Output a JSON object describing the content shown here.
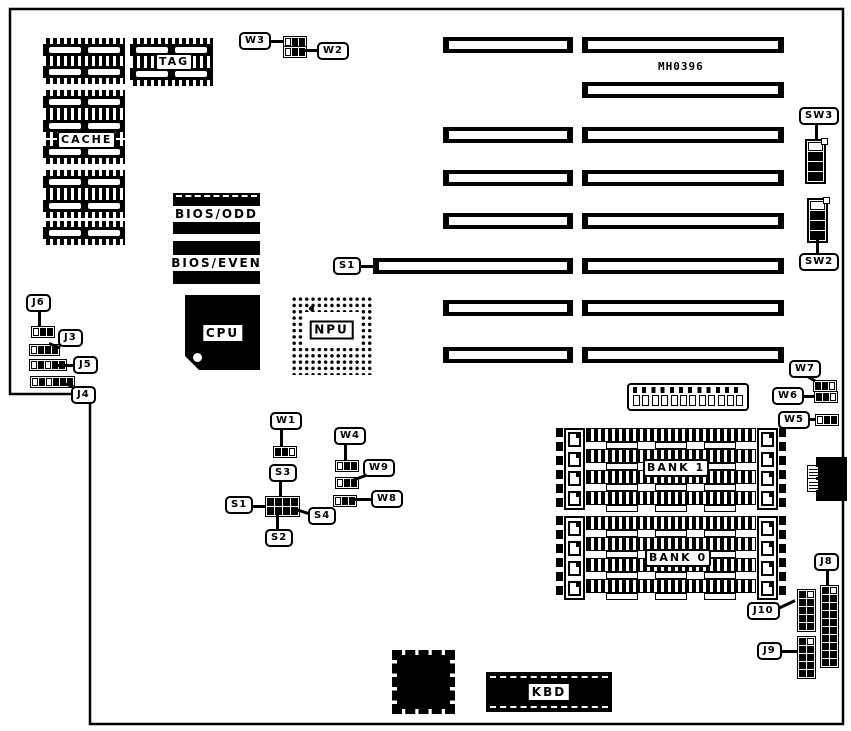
{
  "board": {
    "part_number": "MH0396"
  },
  "components": {
    "cache": {
      "label": "CACHE"
    },
    "tag": {
      "label": "TAG"
    },
    "bios_odd": {
      "label": "BIOS/ODD"
    },
    "bios_even": {
      "label": "BIOS/EVEN"
    },
    "cpu": {
      "label": "CPU"
    },
    "npu": {
      "label": "NPU"
    },
    "kbd": {
      "label": "KBD"
    },
    "bank1": {
      "label": "BANK 1"
    },
    "bank0": {
      "label": "BANK 0"
    }
  },
  "callouts": {
    "w1": {
      "label": "W1",
      "cells": "ffo"
    },
    "w2": {
      "label": "W2",
      "cells": "off"
    },
    "w3": {
      "label": "W3",
      "cells": "off"
    },
    "w4": {
      "label": "W4",
      "cells": "off"
    },
    "w5": {
      "label": "W5",
      "cells": "off"
    },
    "w6": {
      "label": "W6",
      "cells": "ffo"
    },
    "w7": {
      "label": "W7",
      "cells": "ffo"
    },
    "w8": {
      "label": "W8",
      "cells": "off"
    },
    "w9": {
      "label": "W9",
      "cells": "off"
    },
    "j3": {
      "label": "J3",
      "cells": "offf"
    },
    "j4": {
      "label": "J4",
      "cells": "ofofff"
    },
    "j5": {
      "label": "J5",
      "cells": "ofoff"
    },
    "j6": {
      "label": "J6",
      "cells": "off"
    },
    "j8": {
      "label": "J8",
      "cells": "foffffffffffffffffff"
    },
    "j9": {
      "label": "J9",
      "cells": "foffffffff"
    },
    "j10": {
      "label": "J10",
      "cells": "foffffffff"
    },
    "sw2": {
      "label": "SW2",
      "cells": "offf"
    },
    "sw3": {
      "label": "SW3",
      "cells": "offf"
    },
    "s1": {
      "label": "S1"
    },
    "s2": {
      "label": "S2"
    },
    "s3": {
      "label": "S3"
    },
    "s4": {
      "label": "S4"
    },
    "s1_slot": {
      "label": "S1"
    },
    "s_block_cells": "ffffffff",
    "berg_cells": "oooooooooooo"
  },
  "colors": {
    "ink": "#000000",
    "paper": "#ffffff"
  }
}
